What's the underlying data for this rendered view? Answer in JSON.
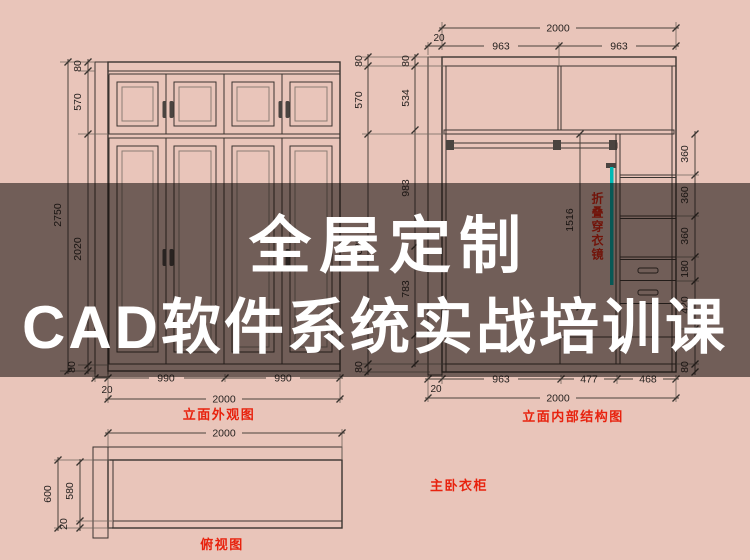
{
  "colors": {
    "background": "#e9c5ba",
    "line": "#3a3430",
    "dim_text": "#262220",
    "accent_red": "#e8220e",
    "mirror_cyan": "#00b9b4",
    "overlay_band": "rgba(15,10,8,0.55)",
    "title_text": "#ffffff"
  },
  "overlay": {
    "title_line1": "全屋定制",
    "title_line2": "CAD软件系统实战培训课"
  },
  "front_view": {
    "label": "立面外观图",
    "dim_total_height": "2750",
    "dim_top": "80",
    "dim_upper": "570",
    "dim_lower": "2020",
    "dim_bottom": "80",
    "dim_wall": "20",
    "dim_door_left": "990",
    "dim_door_right": "990",
    "dim_total_width": "2000"
  },
  "internal_view": {
    "label": "立面内部结构图",
    "mirror_label": "折叠穿衣镜",
    "dim_total_width_top": "2000",
    "dim_wall_top": "20",
    "dim_bay_left": "963",
    "dim_bay_right": "963",
    "outer_top": "80",
    "outer_upper": "570",
    "outer_lower": "2020",
    "outer_bottom": "80",
    "inner_top": "80",
    "inner_upper": "534",
    "inner_mid": "983",
    "inner_lower": "783",
    "dim_hang": "1516",
    "right_chain": [
      "360",
      "360",
      "360",
      "180",
      "420",
      "80"
    ],
    "dim_wall_bottom": "20",
    "bottom_segments": [
      "963",
      "477",
      "468"
    ],
    "dim_total_width_bottom": "2000"
  },
  "top_view": {
    "label": "俯视图",
    "dim_width": "2000",
    "dim_depth": "600",
    "dim_inner_depth": "580",
    "dim_front": "20"
  },
  "caption": "主卧衣柜"
}
